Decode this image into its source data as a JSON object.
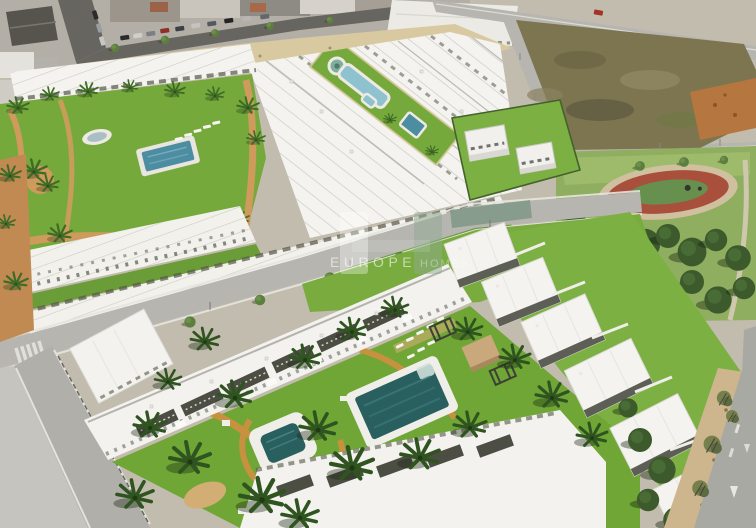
{
  "watermark": {
    "brand_primary": "EUROPE",
    "brand_secondary": "HOMES"
  },
  "palette": {
    "grass": "#76a93c",
    "grass_dark": "#6a9c37",
    "courtyard_grass": "#6fa636",
    "lawn_right": "#7cb043",
    "park_lawn": "#8fae5f",
    "park_tree": "#3c5a2c",
    "path_sand": "#cf9b5c",
    "path_orange": "#c8913f",
    "road": "#b6b5b0",
    "road_dark": "#67655f",
    "sidewalk": "#e6e5e0",
    "roof_white": "#f4f3ef",
    "pergola": "#4c4e44",
    "water_deep": "#2a5f60",
    "water_mid": "#4c8da1",
    "water_light": "#8fc2cf",
    "dirt_lot": "#7d7550",
    "dirt_orange": "#b5763f",
    "sand": "#d9c9a0",
    "track_red": "#a8503c",
    "track_infield": "#67904e",
    "watermark_green": "#8fa98f",
    "watermark_white": "#ffffff"
  },
  "scene": {
    "type": "aerial-render",
    "regions": [
      "existing-town",
      "vacant-lot",
      "public-park",
      "running-track",
      "townhouse-rows",
      "community-garden",
      "lap-pool",
      "fountain",
      "main-pool",
      "kids-pool",
      "courtyard",
      "palm-trees",
      "roads"
    ]
  }
}
